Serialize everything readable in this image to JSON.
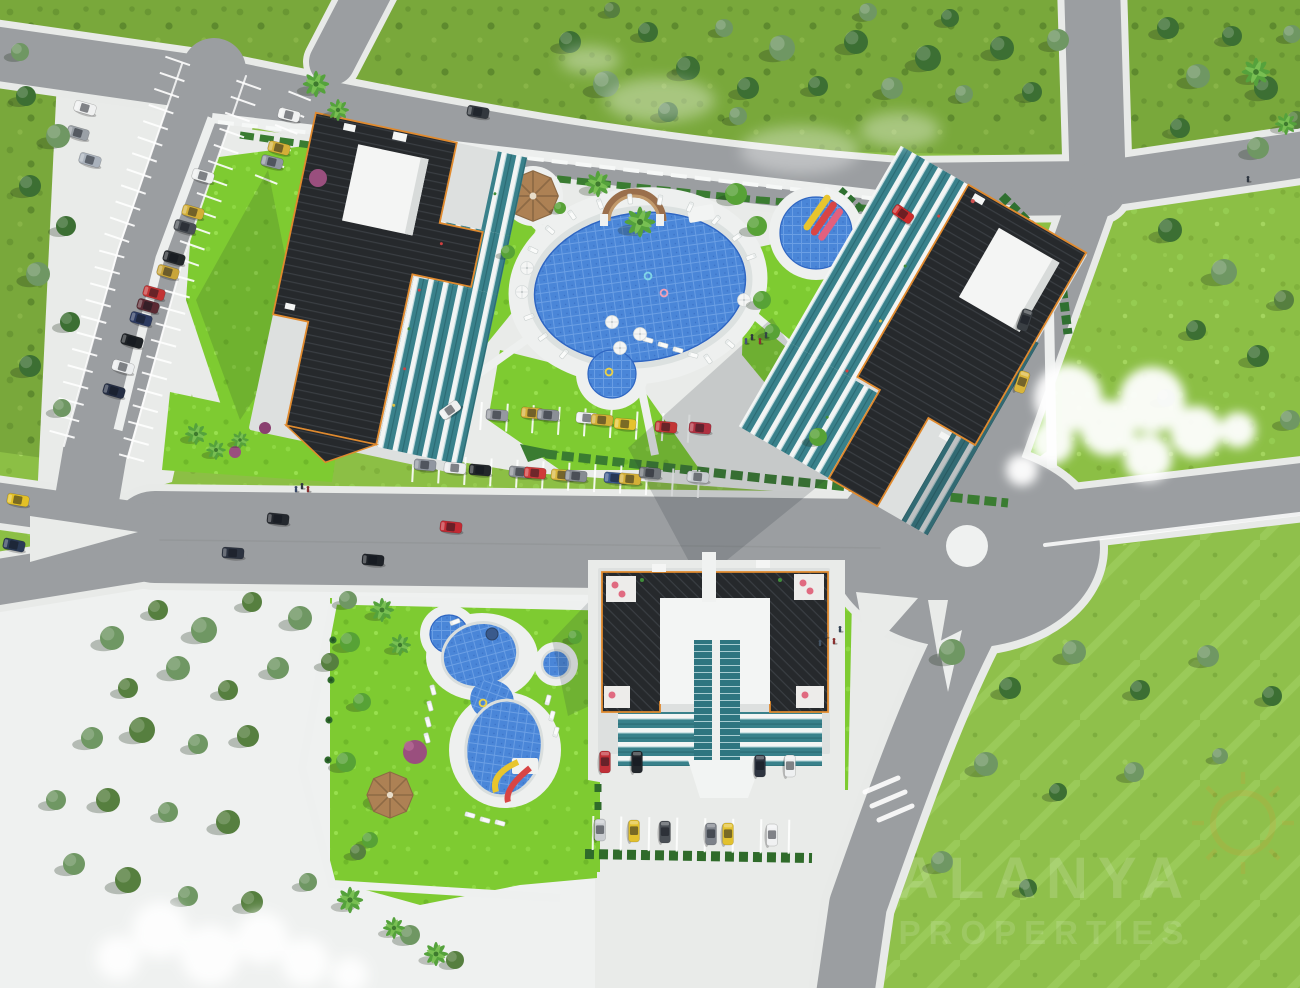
{
  "meta": {
    "title": "Aerial 3D architectural rendering — residential complex site plan",
    "view": "bird's-eye top-down",
    "style": "photoreal 3D visualization"
  },
  "watermark": {
    "line1": "ALANYA",
    "line2": "PROPERTIES",
    "logo": "sunburst"
  },
  "scene": {
    "buildings": [
      {
        "id": "block-a",
        "location": "north-west",
        "roof": "dark charcoal pitched",
        "features": [
          "white penthouse box",
          "teal glass balconies",
          "orange eaves trim"
        ]
      },
      {
        "id": "block-b",
        "location": "east",
        "roof": "dark charcoal pitched",
        "features": [
          "white penthouse box",
          "teal glass balconies",
          "children's pool with slides"
        ]
      },
      {
        "id": "block-c",
        "location": "south",
        "roof": "dark charcoal pitched",
        "features": [
          "white courtyard",
          "glass atrium",
          "entrance canopy",
          "roof terraces with pink parasols"
        ]
      }
    ],
    "pools": [
      {
        "id": "main-pool",
        "shape": "large oval",
        "features": [
          "curved timber bridge",
          "sun loungers",
          "parasols",
          "round kids basin"
        ]
      },
      {
        "id": "kids-pool",
        "shape": "round",
        "features": [
          "three colored slides"
        ]
      },
      {
        "id": "garden-pool",
        "shape": "freeform twin lobe",
        "features": [
          "waterslide",
          "spa circle",
          "round basin",
          "gazebo"
        ]
      }
    ],
    "roads": {
      "roundabout": true,
      "main_boulevard": true,
      "junctions": [
        "west x-junction",
        "north-east y-junction"
      ],
      "street_parking": true
    },
    "parking_lots": 3,
    "landscape": [
      "pine forest",
      "olive grove plaza",
      "bright lawns",
      "palm trees",
      "hedges",
      "meadow"
    ],
    "vehicles_approx": 50,
    "gazebos": 2,
    "clouds": 2
  },
  "colors": {
    "grass": "#8cbf45",
    "forest": "#79a83b",
    "lawn": "#7ecb31",
    "meadow": "#8fc04b",
    "road": "#9b9ea1",
    "sidewalk": "#e8eae8",
    "pavement": "#e9ebe9",
    "plaza": "#eff1f0",
    "pool_water": "#4a86d8",
    "pool_deck": "#eef0ef",
    "roof": "#26292c",
    "roof_trim": "#e08a2e",
    "wall": "#f3f4f3",
    "glass": "#39818b",
    "hedge": "#3a7c31",
    "cloud": "#ffffff",
    "watermark": "#ffffff",
    "sun_logo": "#ef8f2d"
  }
}
